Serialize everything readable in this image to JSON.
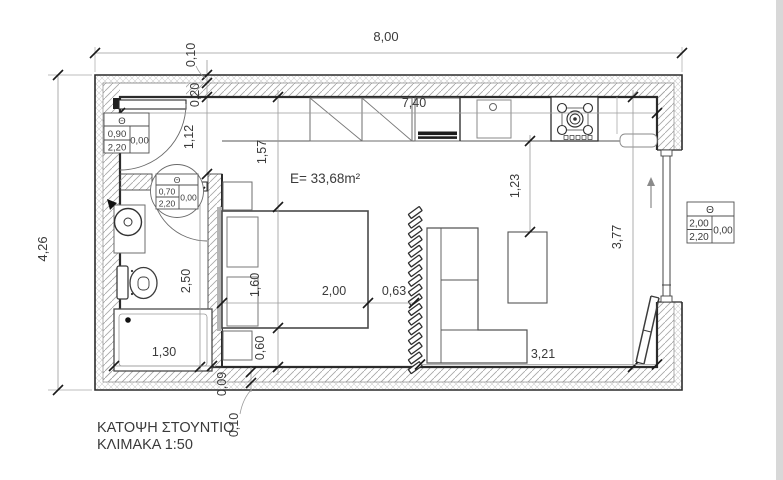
{
  "labels": {
    "title": "ΚΑΤΟΨΗ ΣΤΟΥΝΤΙΟ",
    "scale": "ΚΛΙΜΑΚΑ 1:50",
    "area": "E= 33,68m²"
  },
  "dims": {
    "total_width": "8,00",
    "total_depth": "4,26",
    "ins_top": "0,10",
    "core_top": "0,20",
    "entry_depth": "1,12",
    "closet_zone": "1,57",
    "interior_width": "7,40",
    "counter_gap": "1,23",
    "interior_depth": "3,77",
    "bath_depth": "2,50",
    "bed_width": "1,60",
    "bed_length": "2,00",
    "gap_to_partition": "0,63",
    "bed_to_wall": "0,60",
    "shower_width": "1,30",
    "living_width": "3,21",
    "core_bottom": "0,09",
    "ins_bottom": "0,10"
  },
  "schedules": {
    "entrance": {
      "symbol": "Θ",
      "width": "0,90",
      "height": "2,20",
      "sill": "0,00"
    },
    "bath": {
      "symbol": "Θ",
      "width": "0,70",
      "height": "2,20",
      "sill": "0,00"
    },
    "balcony": {
      "symbol": "Θ",
      "width": "2,00",
      "height": "2,20",
      "sill": "0,00"
    }
  }
}
